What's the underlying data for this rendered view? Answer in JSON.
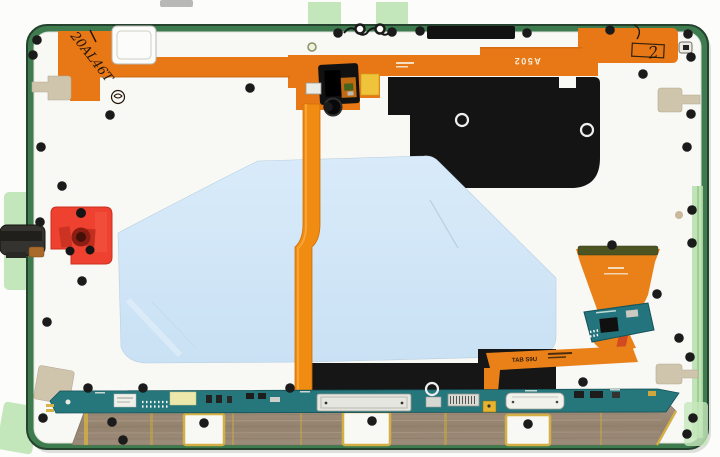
{
  "scene": {
    "description": "Rear-view photograph of a tablet display assembly showing flex cables, graphite sheet, blue protective film, PCBs, copper antenna foil and adhesive pull tabs",
    "background_color": "#fcfcfb"
  },
  "markings": {
    "handwritten_code": "20AL46T",
    "handwritten_digit": "2",
    "flex_print_top": "A502",
    "flex_print_bottom": "TAB S9U"
  },
  "parts": {
    "frame": {
      "label": "mid-frame with green edge",
      "edge_color": "#3e7b4e",
      "surface_color": "#f8f8f5"
    },
    "top_flex": {
      "label": "top flex cable",
      "color": "#e87816"
    },
    "camera_module": {
      "label": "camera module",
      "color": "#111111"
    },
    "graphite": {
      "label": "graphite thermal sheet",
      "color": "#141414"
    },
    "film": {
      "label": "blue protective film",
      "color": "#cfe5f6"
    },
    "ribbon": {
      "label": "interconnect ribbon",
      "color": "#f08c12"
    },
    "gasket": {
      "label": "red camera gasket",
      "color": "#ee4130"
    },
    "clip": {
      "label": "edge clip",
      "color": "#35332f"
    },
    "display_flex": {
      "label": "display flex connector",
      "color": "#ea8018"
    },
    "sub_pcb": {
      "label": "sub PCB",
      "color": "#23747c"
    },
    "main_pcb": {
      "label": "main connector PCB",
      "color": "#26777c"
    },
    "copper_foil": {
      "label": "antenna copper foil",
      "color": "#9e8d7b"
    },
    "pull_tab": {
      "label": "kapton pull tab",
      "color": "#cfc5ad"
    },
    "tape": {
      "label": "green adhesive tape tab",
      "color": "#c4e6bb"
    }
  },
  "hardware": {
    "screw_dots": [
      [
        37,
        40
      ],
      [
        33,
        55
      ],
      [
        110,
        115
      ],
      [
        41,
        147
      ],
      [
        62,
        186
      ],
      [
        40,
        222
      ],
      [
        82,
        281
      ],
      [
        47,
        322
      ],
      [
        250,
        88
      ],
      [
        328,
        107
      ],
      [
        338,
        33
      ],
      [
        392,
        32
      ],
      [
        420,
        31
      ],
      [
        527,
        33
      ],
      [
        610,
        30
      ],
      [
        688,
        34
      ],
      [
        691,
        57
      ],
      [
        643,
        74
      ],
      [
        691,
        114
      ],
      [
        687,
        147
      ],
      [
        692,
        210
      ],
      [
        612,
        245
      ],
      [
        692,
        243
      ],
      [
        657,
        294
      ],
      [
        679,
        338
      ],
      [
        690,
        357
      ],
      [
        693,
        418
      ],
      [
        687,
        434
      ],
      [
        88,
        388
      ],
      [
        143,
        388
      ],
      [
        290,
        388
      ],
      [
        583,
        382
      ],
      [
        204,
        423
      ],
      [
        372,
        421
      ],
      [
        528,
        424
      ],
      [
        43,
        418
      ],
      [
        112,
        422
      ],
      [
        123,
        440
      ]
    ],
    "white_rings": [
      [
        462,
        120
      ],
      [
        587,
        130
      ],
      [
        432,
        389
      ]
    ],
    "edge_holes": [
      [
        360,
        29
      ],
      [
        380,
        29
      ]
    ],
    "pale_ring": [
      312,
      47
    ],
    "tan_dot": [
      679,
      215
    ]
  }
}
